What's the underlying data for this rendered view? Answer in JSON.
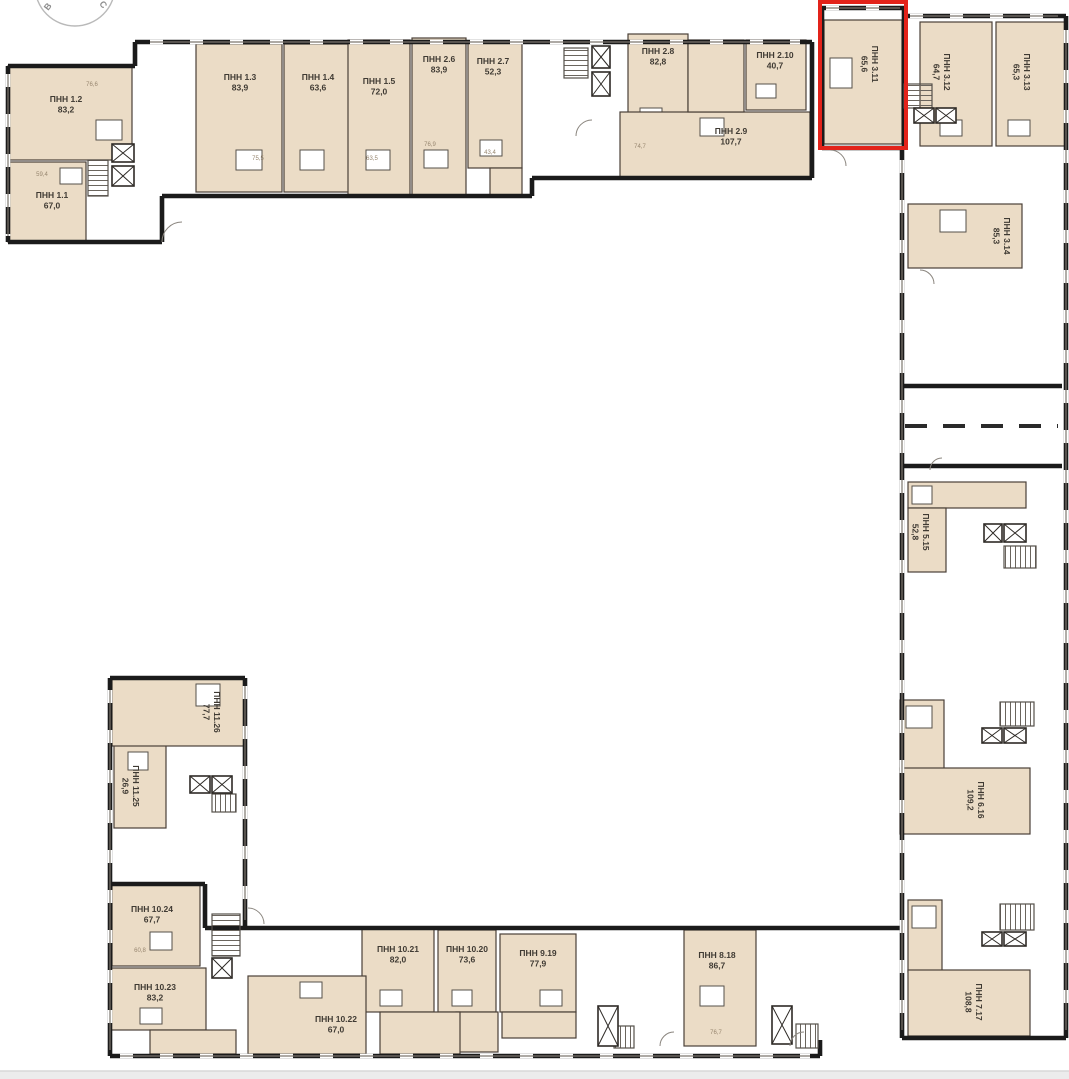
{
  "page": {
    "background": "#ffffff"
  },
  "compass": {
    "west_label": "В",
    "north_label": "С"
  },
  "highlight": {
    "apartment_id": "3.11",
    "color": "#e2231a"
  },
  "colors": {
    "apartment_fill": "#ebdcc6",
    "apartment_fill_light": "#f2e8d9",
    "wall": "#1b1b1b",
    "thin_line": "#4a4038",
    "core_line": "#55504a",
    "label_text": "#3f3a33",
    "room_label_text": "#97866f",
    "highlight_red": "#e2231a",
    "footer_bar": "#ececec",
    "footer_line": "#d8d8d8",
    "compass_gray": "#9a9a9a"
  },
  "apartments": [
    {
      "id": "1.1",
      "name": "ПНН 1.1",
      "area": "67,0",
      "highlighted": false
    },
    {
      "id": "1.2",
      "name": "ПНН 1.2",
      "area": "83,2",
      "highlighted": false
    },
    {
      "id": "1.3",
      "name": "ПНН 1.3",
      "area": "83,9",
      "highlighted": false
    },
    {
      "id": "1.4",
      "name": "ПНН 1.4",
      "area": "63,6",
      "highlighted": false
    },
    {
      "id": "1.5",
      "name": "ПНН 1.5",
      "area": "72,0",
      "highlighted": false
    },
    {
      "id": "2.6",
      "name": "ПНН 2.6",
      "area": "83,9",
      "highlighted": false
    },
    {
      "id": "2.7",
      "name": "ПНН 2.7",
      "area": "52,3",
      "highlighted": false
    },
    {
      "id": "2.8",
      "name": "ПНН 2.8",
      "area": "82,8",
      "highlighted": false
    },
    {
      "id": "2.9",
      "name": "ПНН 2.9",
      "area": "107,7",
      "highlighted": false
    },
    {
      "id": "2.10",
      "name": "ПНН 2.10",
      "area": "40,7",
      "highlighted": false
    },
    {
      "id": "3.11",
      "name": "ПНН 3.11",
      "area": "65,6",
      "highlighted": true
    },
    {
      "id": "3.12",
      "name": "ПНН 3.12",
      "area": "64,7",
      "highlighted": false
    },
    {
      "id": "3.13",
      "name": "ПНН 3.13",
      "area": "65,3",
      "highlighted": false
    },
    {
      "id": "3.14",
      "name": "ПНН 3.14",
      "area": "85,3",
      "highlighted": false
    },
    {
      "id": "5.15",
      "name": "ПНН 5.15",
      "area": "52,8",
      "highlighted": false
    },
    {
      "id": "6.16",
      "name": "ПНН 6.16",
      "area": "109,2",
      "highlighted": false
    },
    {
      "id": "7.17",
      "name": "ПНН 7.17",
      "area": "108,8",
      "highlighted": false
    },
    {
      "id": "8.18",
      "name": "ПНН 8.18",
      "area": "86,7",
      "highlighted": false
    },
    {
      "id": "9.19",
      "name": "ПНН 9.19",
      "area": "77,9",
      "highlighted": false
    },
    {
      "id": "10.20",
      "name": "ПНН 10.20",
      "area": "73,6",
      "highlighted": false
    },
    {
      "id": "10.21",
      "name": "ПНН 10.21",
      "area": "82,0",
      "highlighted": false
    },
    {
      "id": "10.22",
      "name": "ПНН 10.22",
      "area": "67,0",
      "highlighted": false
    },
    {
      "id": "10.23",
      "name": "ПНН 10.23",
      "area": "83,2",
      "highlighted": false
    },
    {
      "id": "10.24",
      "name": "ПНН 10.24",
      "area": "67,7",
      "highlighted": false
    },
    {
      "id": "11.25",
      "name": "ПНН 11.25",
      "area": "26,9",
      "highlighted": false
    },
    {
      "id": "11.26",
      "name": "ПНН 11.26",
      "area": "77,7",
      "highlighted": false
    }
  ],
  "room_labels": [
    "76,6",
    "59,4",
    "75,5",
    "63,5",
    "76,9",
    "43,4",
    "74,7",
    "60,8",
    "76,7"
  ]
}
